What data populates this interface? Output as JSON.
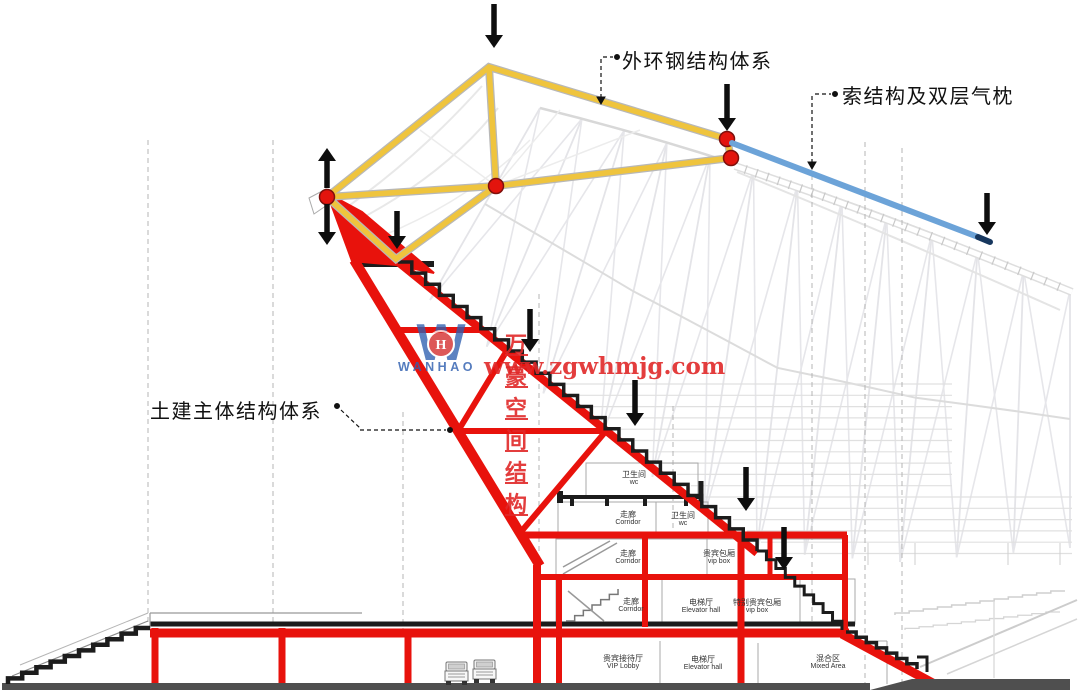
{
  "annotations": {
    "outer_ring_label": "外环钢结构体系",
    "cable_label": "索结构及双层气枕",
    "civil_label": "土建主体结构体系"
  },
  "watermark": {
    "logo_letter": "W",
    "logo_monogram": "H",
    "logo_name": "WANHAO",
    "brand_cn": "万豪空间结构",
    "website": "www.zgwhmjg.com"
  },
  "rooms": [
    {
      "cn": "卫生间",
      "en": "wc"
    },
    {
      "cn": "走廊",
      "en": "Corridor"
    },
    {
      "cn": "卫生间",
      "en": "wc"
    },
    {
      "cn": "走廊",
      "en": "Corridor"
    },
    {
      "cn": "贵宾包厢",
      "en": "vip box"
    },
    {
      "cn": "走廊",
      "en": "Corridor"
    },
    {
      "cn": "电梯厅",
      "en": "Elevator hall"
    },
    {
      "cn": "特别贵宾包厢",
      "en": "vip box"
    },
    {
      "cn": "贵宾接待厅",
      "en": "VIP Lobby"
    },
    {
      "cn": "电梯厅",
      "en": "Elevator hall"
    },
    {
      "cn": "混合区",
      "en": "Mixed Area"
    }
  ],
  "colors": {
    "steel_ring_yellow": "#EFC43D",
    "cable_blue": "#6CA3D8",
    "cable_tip_dark": "#17375E",
    "structure_red": "#E8120C",
    "node_red": "#E3140D",
    "arrow_black": "#0E0E0E",
    "watermark_blue": "#2F5FB0",
    "watermark_red": "#E02828"
  },
  "icons": {
    "load_arrow_down": "down-arrow",
    "load_arrow_up": "up-arrow",
    "truck": "truck-front-view",
    "node": "pin-joint-circle"
  }
}
